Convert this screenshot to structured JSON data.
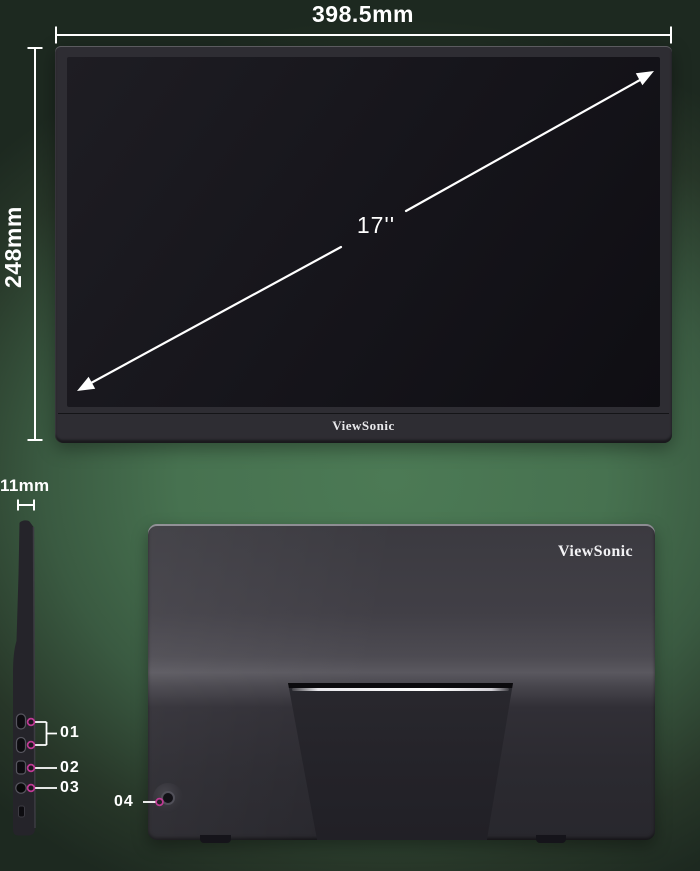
{
  "colors": {
    "background_green": "#47714e",
    "callout_accent": "#c13a95",
    "dimension_line": "#ffffff"
  },
  "front_view": {
    "width_label": "398.5mm",
    "height_label": "248mm",
    "diagonal_label": "17''",
    "brand_logo": "ViewSonic"
  },
  "side_view": {
    "thickness_label": "11mm",
    "callouts": [
      {
        "label": "01"
      },
      {
        "label": "02"
      },
      {
        "label": "03"
      }
    ]
  },
  "back_view": {
    "brand_logo": "ViewSonic",
    "callout": {
      "label": "04"
    }
  }
}
